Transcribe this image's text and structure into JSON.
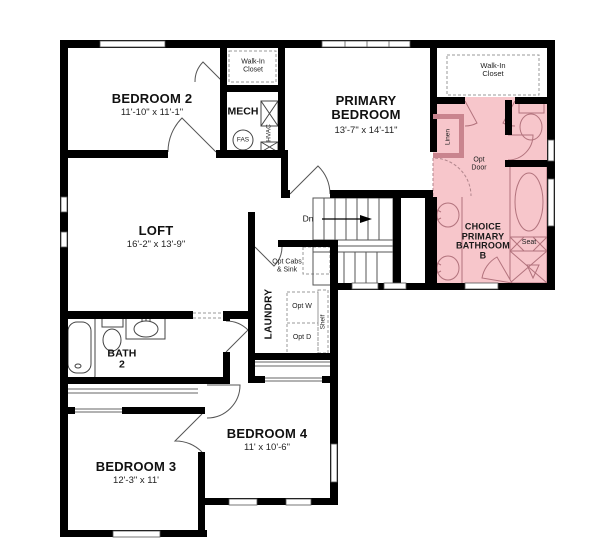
{
  "rooms": {
    "bedroom2": {
      "name": "BEDROOM 2",
      "dims": "11'-10\" x 11'-1\""
    },
    "primary": {
      "name": "PRIMARY BEDROOM",
      "dims": "13'-7\" x 14'-11\""
    },
    "loft": {
      "name": "LOFT",
      "dims": "16'-2\" x 13'-9\""
    },
    "bedroom3": {
      "name": "BEDROOM 3",
      "dims": "12'-3\" x 11'"
    },
    "bedroom4": {
      "name": "BEDROOM 4",
      "dims": "11' x 10'-6\""
    },
    "bath2": {
      "name": "BATH 2"
    },
    "choice_bath": {
      "name": "CHOICE PRIMARY BATHROOM B"
    },
    "laundry": {
      "name": "LAUNDRY"
    },
    "mech": {
      "name": "MECH"
    },
    "walkin_closet_bedroom2": {
      "name": "Walk-In Closet"
    },
    "walkin_closet_primary": {
      "name": "Walk-In Closet"
    }
  },
  "annotations": {
    "linen": "Linen",
    "opt_door": "Opt Door",
    "seat": "Seat",
    "down": "Dn",
    "opt_cabs_sink": "Opt Cabs & Sink",
    "opt_washer": "Opt W",
    "opt_dryer": "Opt D",
    "shelf": "Shelf",
    "hvac": "HVAC",
    "fas": "FAS"
  },
  "colors": {
    "highlight_fill": "#f7c6cb",
    "highlight_stroke": "#b2737d",
    "highlight_wall": "#c9848e",
    "wall": "#000000"
  }
}
